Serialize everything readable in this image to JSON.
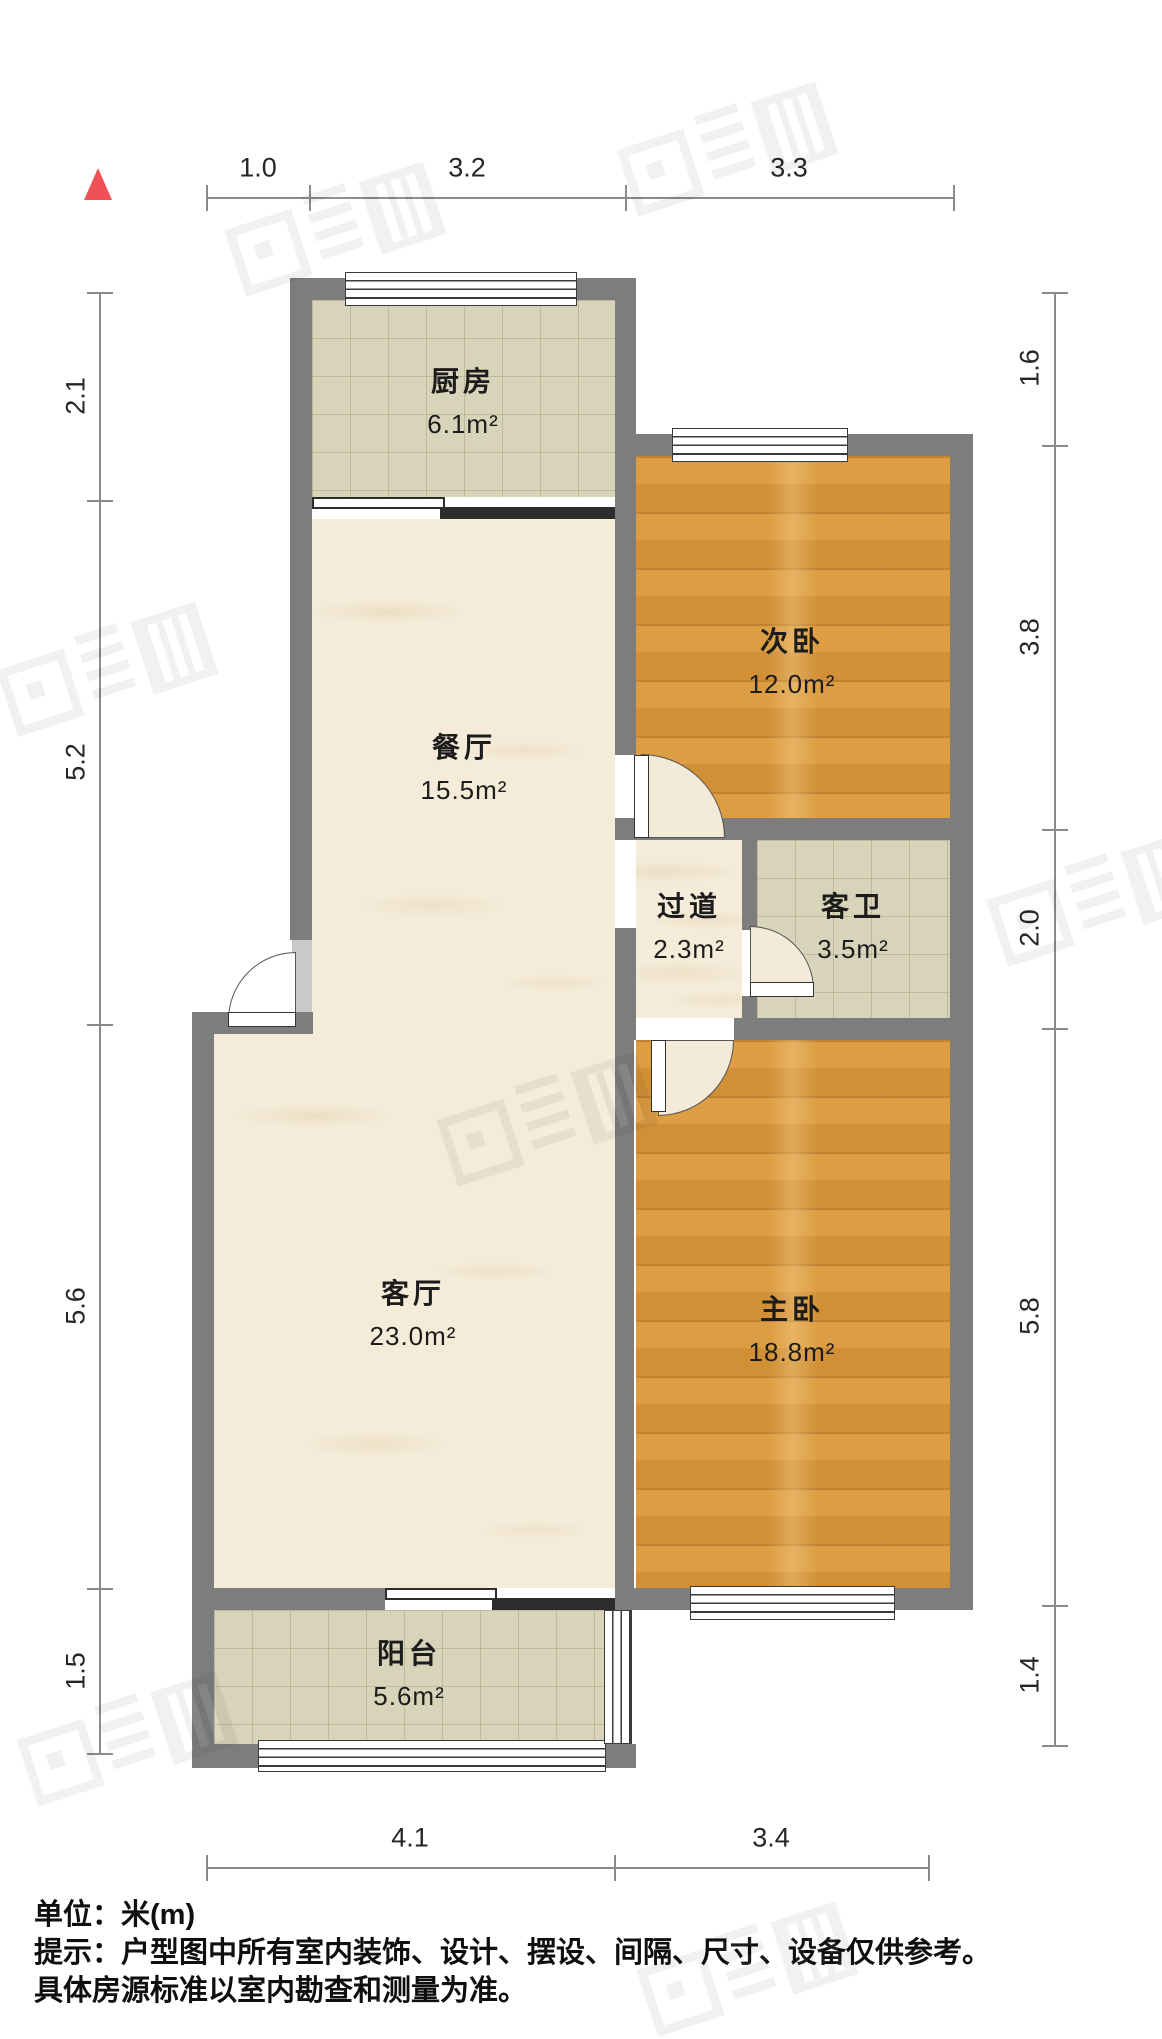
{
  "rooms": {
    "kitchen": {
      "name": "厨房",
      "area": "6.1m²"
    },
    "second_bedroom": {
      "name": "次卧",
      "area": "12.0m²"
    },
    "dining": {
      "name": "餐厅",
      "area": "15.5m²"
    },
    "hallway": {
      "name": "过道",
      "area": "2.3m²"
    },
    "guest_bath": {
      "name": "客卫",
      "area": "3.5m²"
    },
    "living": {
      "name": "客厅",
      "area": "23.0m²"
    },
    "master_bedroom": {
      "name": "主卧",
      "area": "18.8m²"
    },
    "balcony": {
      "name": "阳台",
      "area": "5.6m²"
    }
  },
  "dimensions": {
    "top": [
      "1.0",
      "3.2",
      "3.3"
    ],
    "bottom": [
      "4.1",
      "3.4"
    ],
    "left": [
      "2.1",
      "5.2",
      "5.6",
      "1.5"
    ],
    "right": [
      "1.6",
      "3.8",
      "2.0",
      "5.8",
      "1.4"
    ]
  },
  "footer": {
    "unit": "单位：米(m)",
    "note1": "提示：户型图中所有室内装饰、设计、摆设、间隔、尺寸、设备仅供参考。",
    "note2": "具体房源标准以室内勘查和测量为准。"
  },
  "colors": {
    "wall": "#7d7d7d",
    "wood_floor": "#d8973a",
    "tile_floor": "#d8d4ba",
    "marble_floor": "#f4ecd9",
    "north_arrow": "#f05156"
  }
}
